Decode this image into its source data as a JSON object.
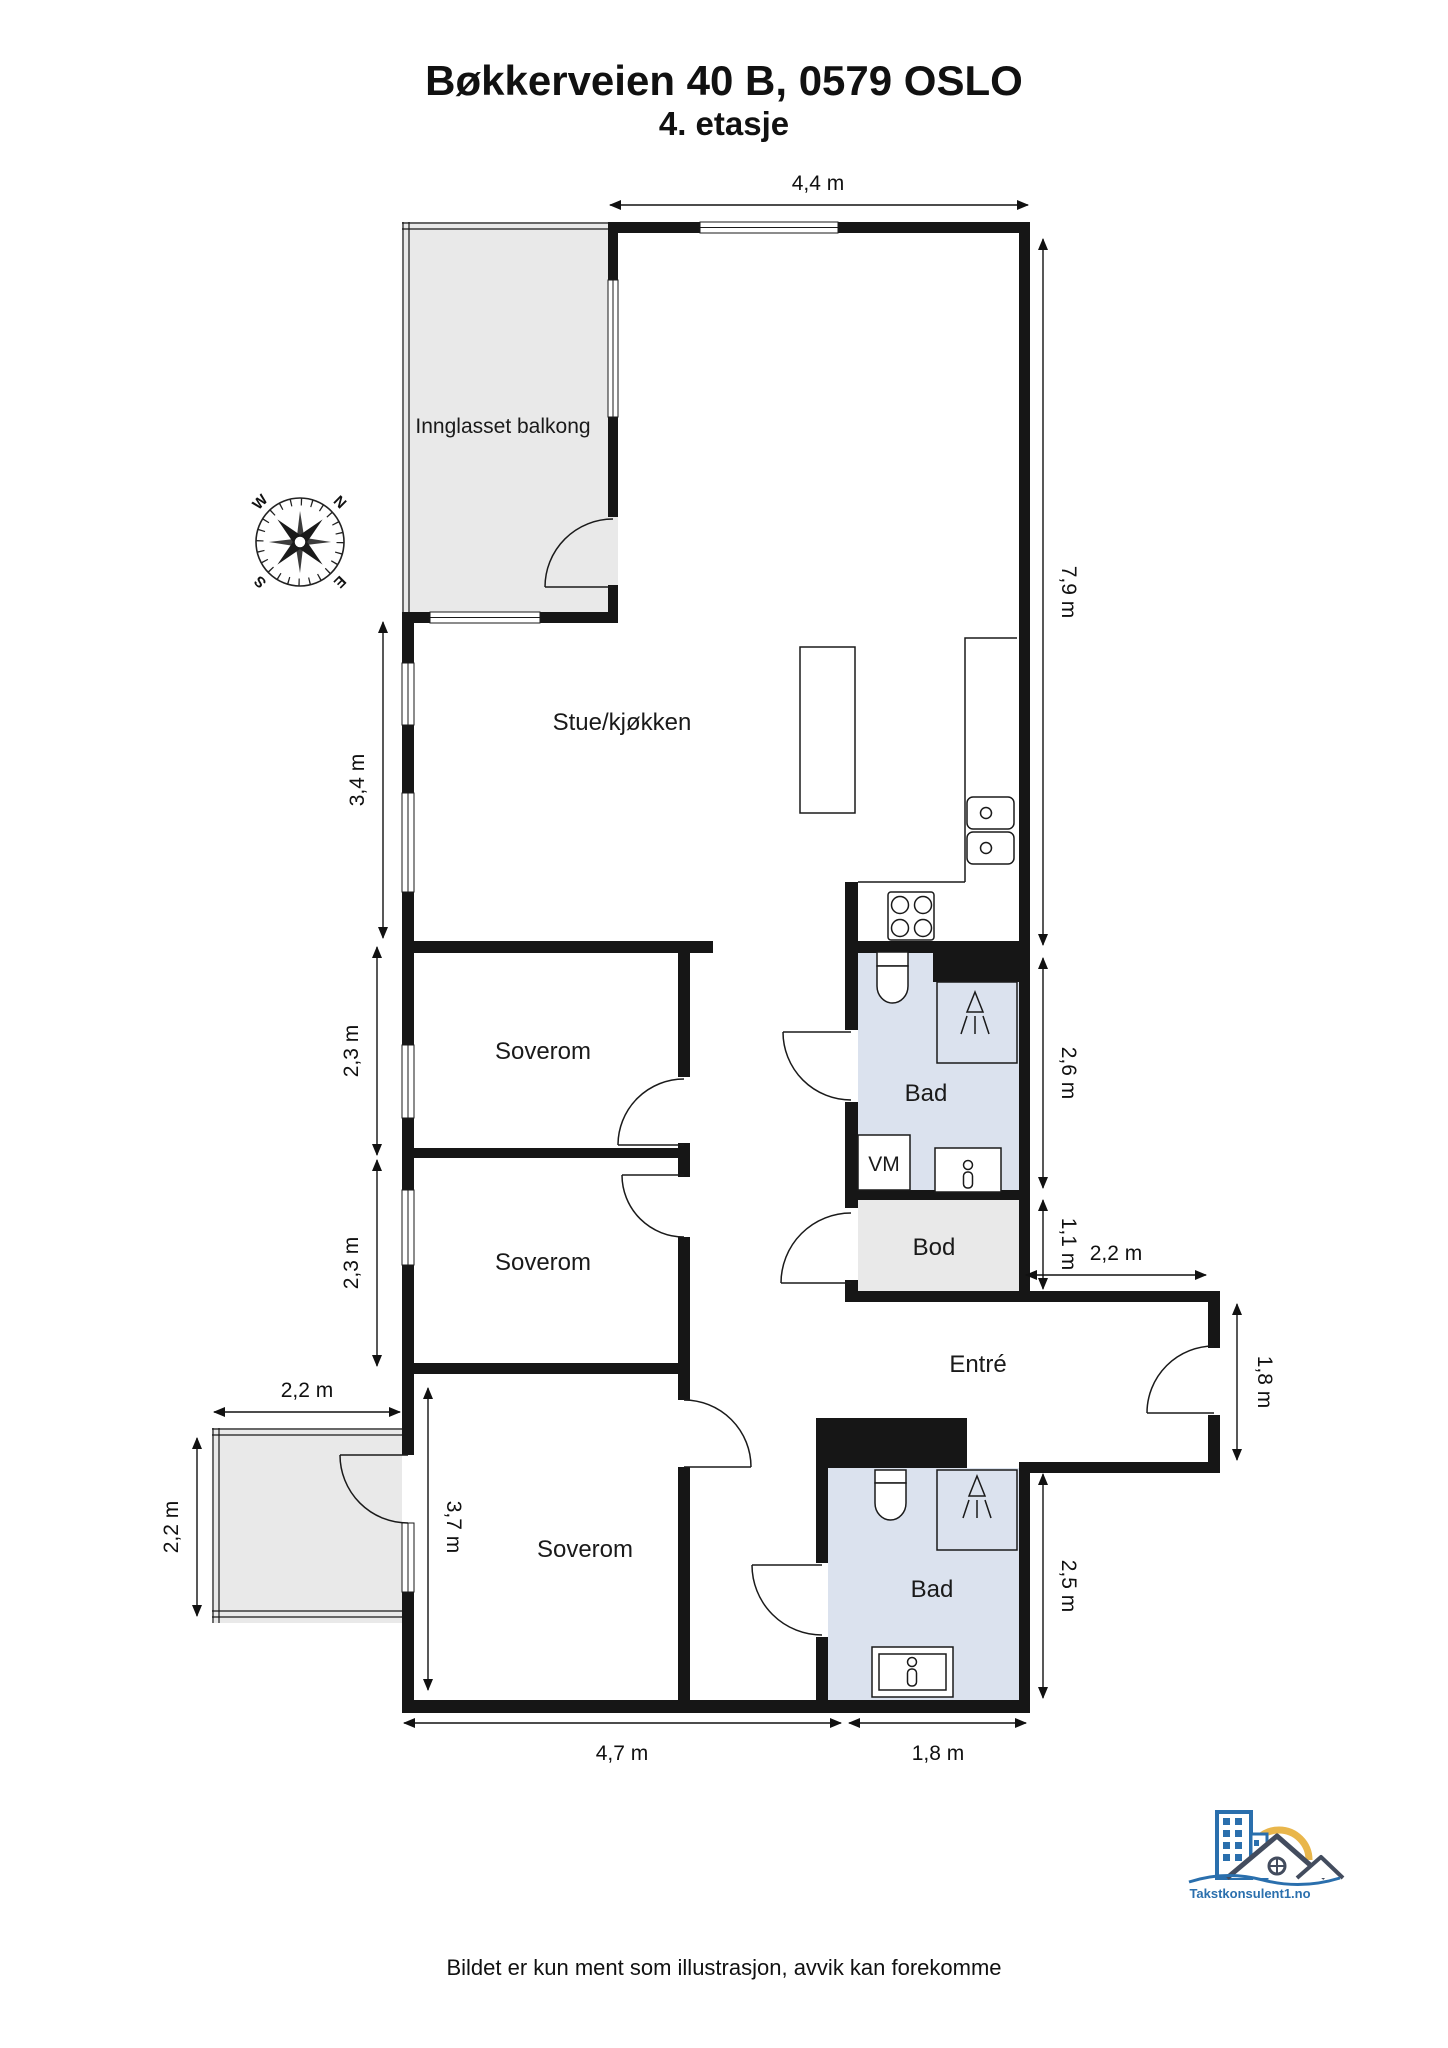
{
  "title": "Bøkkerveien 40 B, 0579 OSLO",
  "subtitle": "4. etasje",
  "disclaimer": "Bildet er kun ment som illustrasjon, avvik kan forekomme",
  "logo_text": "Takstkonsulent1.no",
  "compass": {
    "north": "N",
    "east": "E",
    "south": "S",
    "west": "W"
  },
  "colors": {
    "wall": "#161616",
    "balcony_fill": "#e9e9e9",
    "bathroom_fill": "#dbe2ee",
    "storage_fill": "#e9e9e9",
    "logo_blue": "#2a6fad",
    "logo_yellow": "#e9b64b",
    "logo_roof": "#434c5e"
  },
  "rooms": {
    "glazed_balcony": "Innglasset balkong",
    "living_kitchen": "Stue/kjøkken",
    "bedroom1": "Soverom",
    "bedroom2": "Soverom",
    "bedroom3": "Soverom",
    "bathroom1": "Bad",
    "bathroom2": "Bad",
    "storage": "Bod",
    "entry": "Entré",
    "washer": "VM"
  },
  "dimensions": {
    "top_width": "4,4 m",
    "right_height": "7,9 m",
    "living_left": "3,4 m",
    "bedroom1_left": "2,3 m",
    "bedroom2_left": "2,3 m",
    "bath1_right": "2,6 m",
    "storage_right": "1,1 m",
    "hall_width": "2,2 m",
    "entry_door": "1,8 m",
    "bath2_right": "2,5 m",
    "bedroom3_width": "4,7 m",
    "bath2_width": "1,8 m",
    "bedroom3_height": "3,7 m",
    "balcony_width": "2,2 m",
    "balcony_height": "2,2 m"
  }
}
